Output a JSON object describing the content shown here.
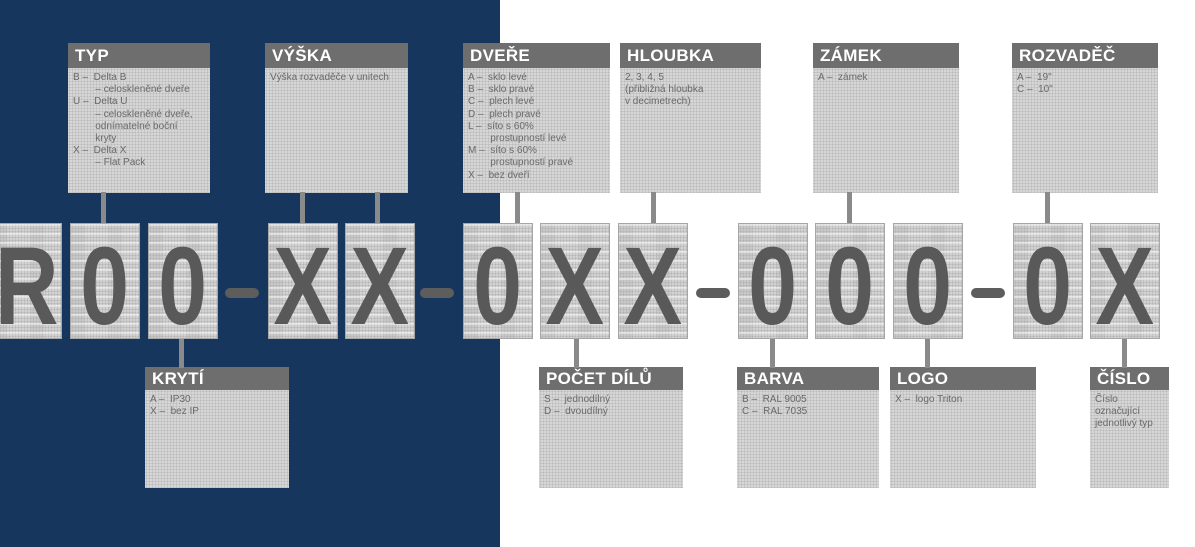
{
  "palette": {
    "background_left": "#17365d",
    "background_right": "#ffffff",
    "box_header": "#6e6e6e",
    "box_body": "#d6d6d6",
    "glyph": "#595959",
    "connector": "#8a8a8a"
  },
  "code": {
    "display": "R00–XX–0XX–000–0X",
    "separator": "–",
    "chars": [
      "R",
      "0",
      "0",
      "X",
      "X",
      "0",
      "X",
      "X",
      "0",
      "0",
      "0",
      "0",
      "X"
    ]
  },
  "top_boxes": [
    {
      "title": "TYP",
      "body": "B –  Delta B\n        – celoskleněné dveře\nU –  Delta U\n        – celoskleněné dveře,\n        odnímatelné boční\n        kryty\nX –  Delta X\n        – Flat Pack"
    },
    {
      "title": "VÝŠKA",
      "body": "Výška rozvaděče v unitech"
    },
    {
      "title": "DVEŘE",
      "body": "A –  sklo levé\nB –  sklo pravé\nC –  plech levé\nD –  plech pravé\nL –  síto s 60%\n        prostupností levé\nM –  síto s 60%\n        prostupností pravé\nX –  bez dveří"
    },
    {
      "title": "HLOUBKA",
      "body": "2, 3, 4, 5\n(přibližná hloubka\nv decimetrech)"
    },
    {
      "title": "ZÁMEK",
      "body": "A –  zámek"
    },
    {
      "title": "ROZVADĚČ",
      "body": "A –  19\"\nC –  10\""
    }
  ],
  "bottom_boxes": [
    {
      "title": "KRYTÍ",
      "body": "A –  IP30\nX –  bez IP"
    },
    {
      "title": "POČET DÍLŮ",
      "body": "S –  jednodílný\nD –  dvoudílný"
    },
    {
      "title": "BARVA",
      "body": "B –  RAL 9005\nC –  RAL 7035"
    },
    {
      "title": "LOGO",
      "body": "X –  logo Triton"
    },
    {
      "title": "ČÍSLO",
      "body": "Číslo označující\njednotlivý typ"
    }
  ]
}
